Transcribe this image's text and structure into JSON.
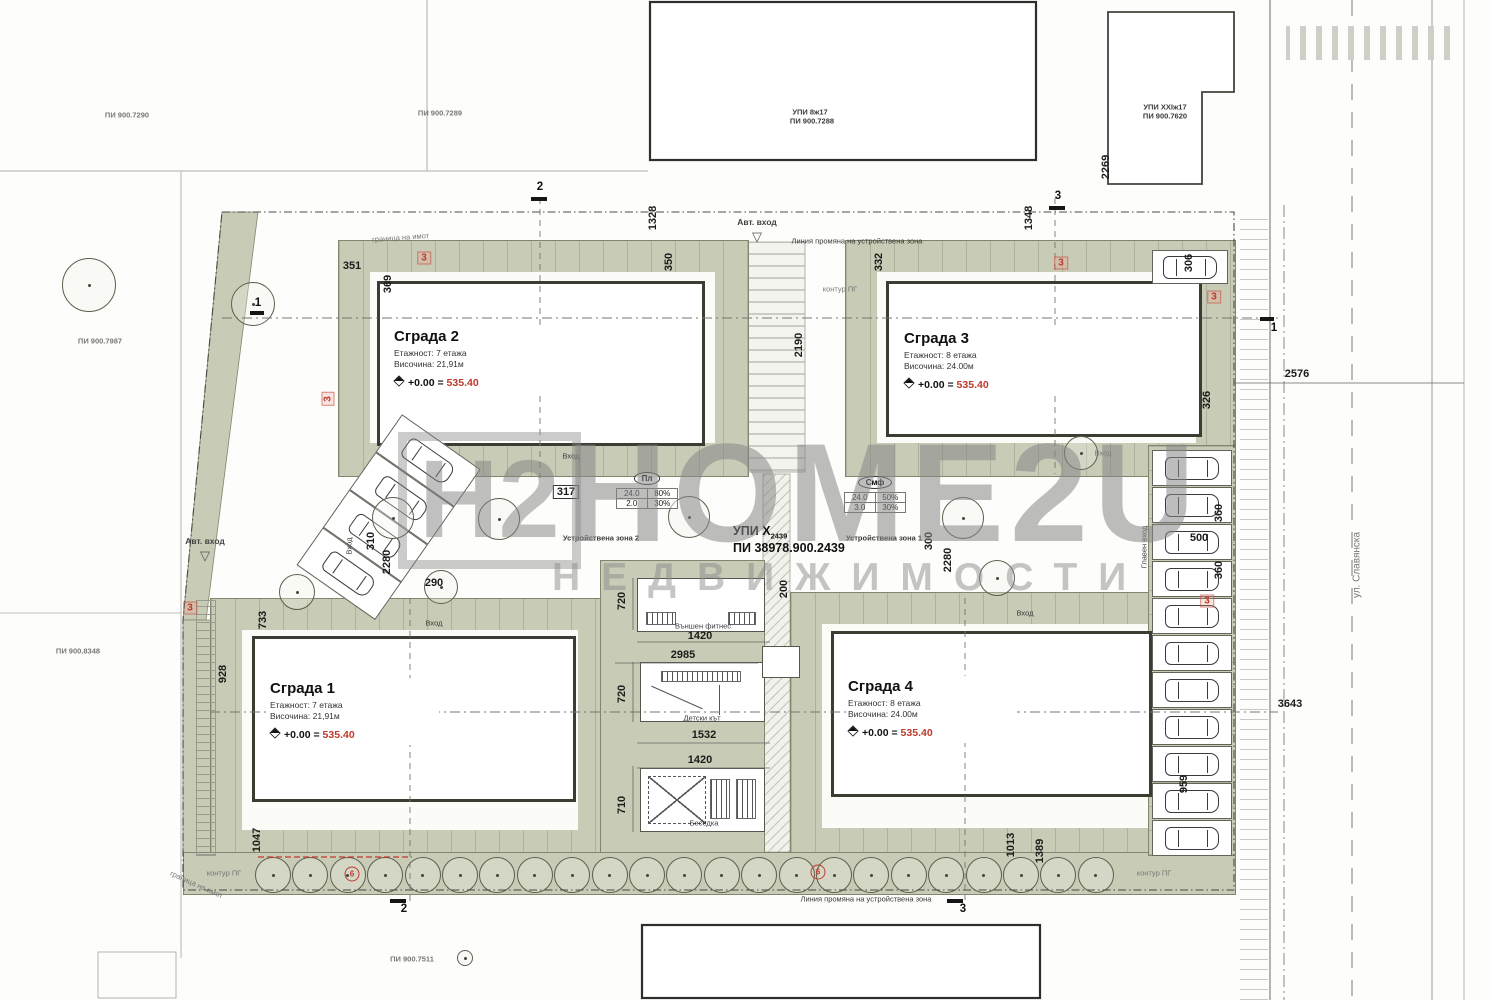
{
  "site": {
    "upi": "УПИ X",
    "upi_sub": "2439",
    "pi": "ПИ 38978.900.2439",
    "street": "ул. Славянска"
  },
  "neighbors": {
    "pi_7290": "ПИ 900.7290",
    "pi_7289": "ПИ 900.7289",
    "upi_8": "УПИ 8ж17",
    "pi_7288": "ПИ 900.7288",
    "upi_xxi": "УПИ XXIж17",
    "pi_7620": "ПИ 900.7620",
    "pi_7987": "ПИ 900.7987",
    "pi_8348": "ПИ 900.8348",
    "pi_7511": "ПИ 900.7511"
  },
  "buildings": {
    "b1": {
      "name": "Сграда 1",
      "floors": "Етажност: 7 етажа",
      "height": "Височина: 21,91м",
      "elev": "+0.00 =",
      "elev_value": "535.40"
    },
    "b2": {
      "name": "Сграда 2",
      "floors": "Етажност: 7 етажа",
      "height": "Височина: 21,91м",
      "elev": "+0.00 =",
      "elev_value": "535.40"
    },
    "b3": {
      "name": "Сграда 3",
      "floors": "Етажност: 8 етажа",
      "height": "Височина: 24.00м",
      "elev": "+0.00 =",
      "elev_value": "535.40"
    },
    "b4": {
      "name": "Сграда 4",
      "floors": "Етажност: 8 етажа",
      "height": "Височина: 24.00м",
      "elev": "+0.00 =",
      "elev_value": "535.40"
    }
  },
  "zones": {
    "zone1": "Устройствена зона 1",
    "zone2": "Устройствена зона 2",
    "change_line": "Линия промяна на устройствена зона"
  },
  "tables": {
    "pl": {
      "title": "Пл",
      "rows": [
        [
          "24.0",
          "80%"
        ],
        [
          "2.0",
          "30%"
        ]
      ]
    },
    "smf": {
      "title": "Смф",
      "rows": [
        [
          "24.0",
          "50%"
        ],
        [
          "3.0",
          "30%"
        ]
      ]
    }
  },
  "entrances": {
    "auto": "Авт. вход",
    "entry": "Вход",
    "main": "Главен вход"
  },
  "amenities": {
    "fitness": "Външен фитнес",
    "playground": "Детски кът",
    "gazebo": "Беседка"
  },
  "labels": {
    "kontur": "контур ПГ",
    "granica": "граница на имот"
  },
  "sections": {
    "s1": "1",
    "s2": "2",
    "s3": "3"
  },
  "marks": {
    "red3": "3",
    "red6": "6"
  },
  "watermark": {
    "logo": "H2",
    "brand": "HOME2U",
    "subtitle": "НЕДВИЖИМОСТИ"
  },
  "dims": {
    "v1328": "1328",
    "v1348": "1348",
    "v2190": "2190",
    "v2269": "2269",
    "h2576": "2576",
    "h3643": "3643",
    "v350": "350",
    "v332": "332",
    "v369": "369",
    "h351": "351",
    "v306": "306",
    "v326": "326",
    "h317": "317",
    "v310": "310",
    "v2280_left": "2280",
    "h290": "290",
    "v733": "733",
    "v928": "928",
    "v1047": "1047",
    "v720_a": "720",
    "v720_b": "720",
    "v710": "710",
    "h1420_a": "1420",
    "h2985": "2985",
    "h1532": "1532",
    "h1420_b": "1420",
    "v200": "200",
    "v300": "300",
    "v2280_right": "2280",
    "v360_a": "360",
    "h500": "500",
    "v360_b": "360",
    "v959": "959",
    "v1013": "1013",
    "v1389": "1389"
  },
  "colors": {
    "green": "#c8cbb5",
    "red": "#bf3a2b",
    "wall": "#3b3c32"
  }
}
